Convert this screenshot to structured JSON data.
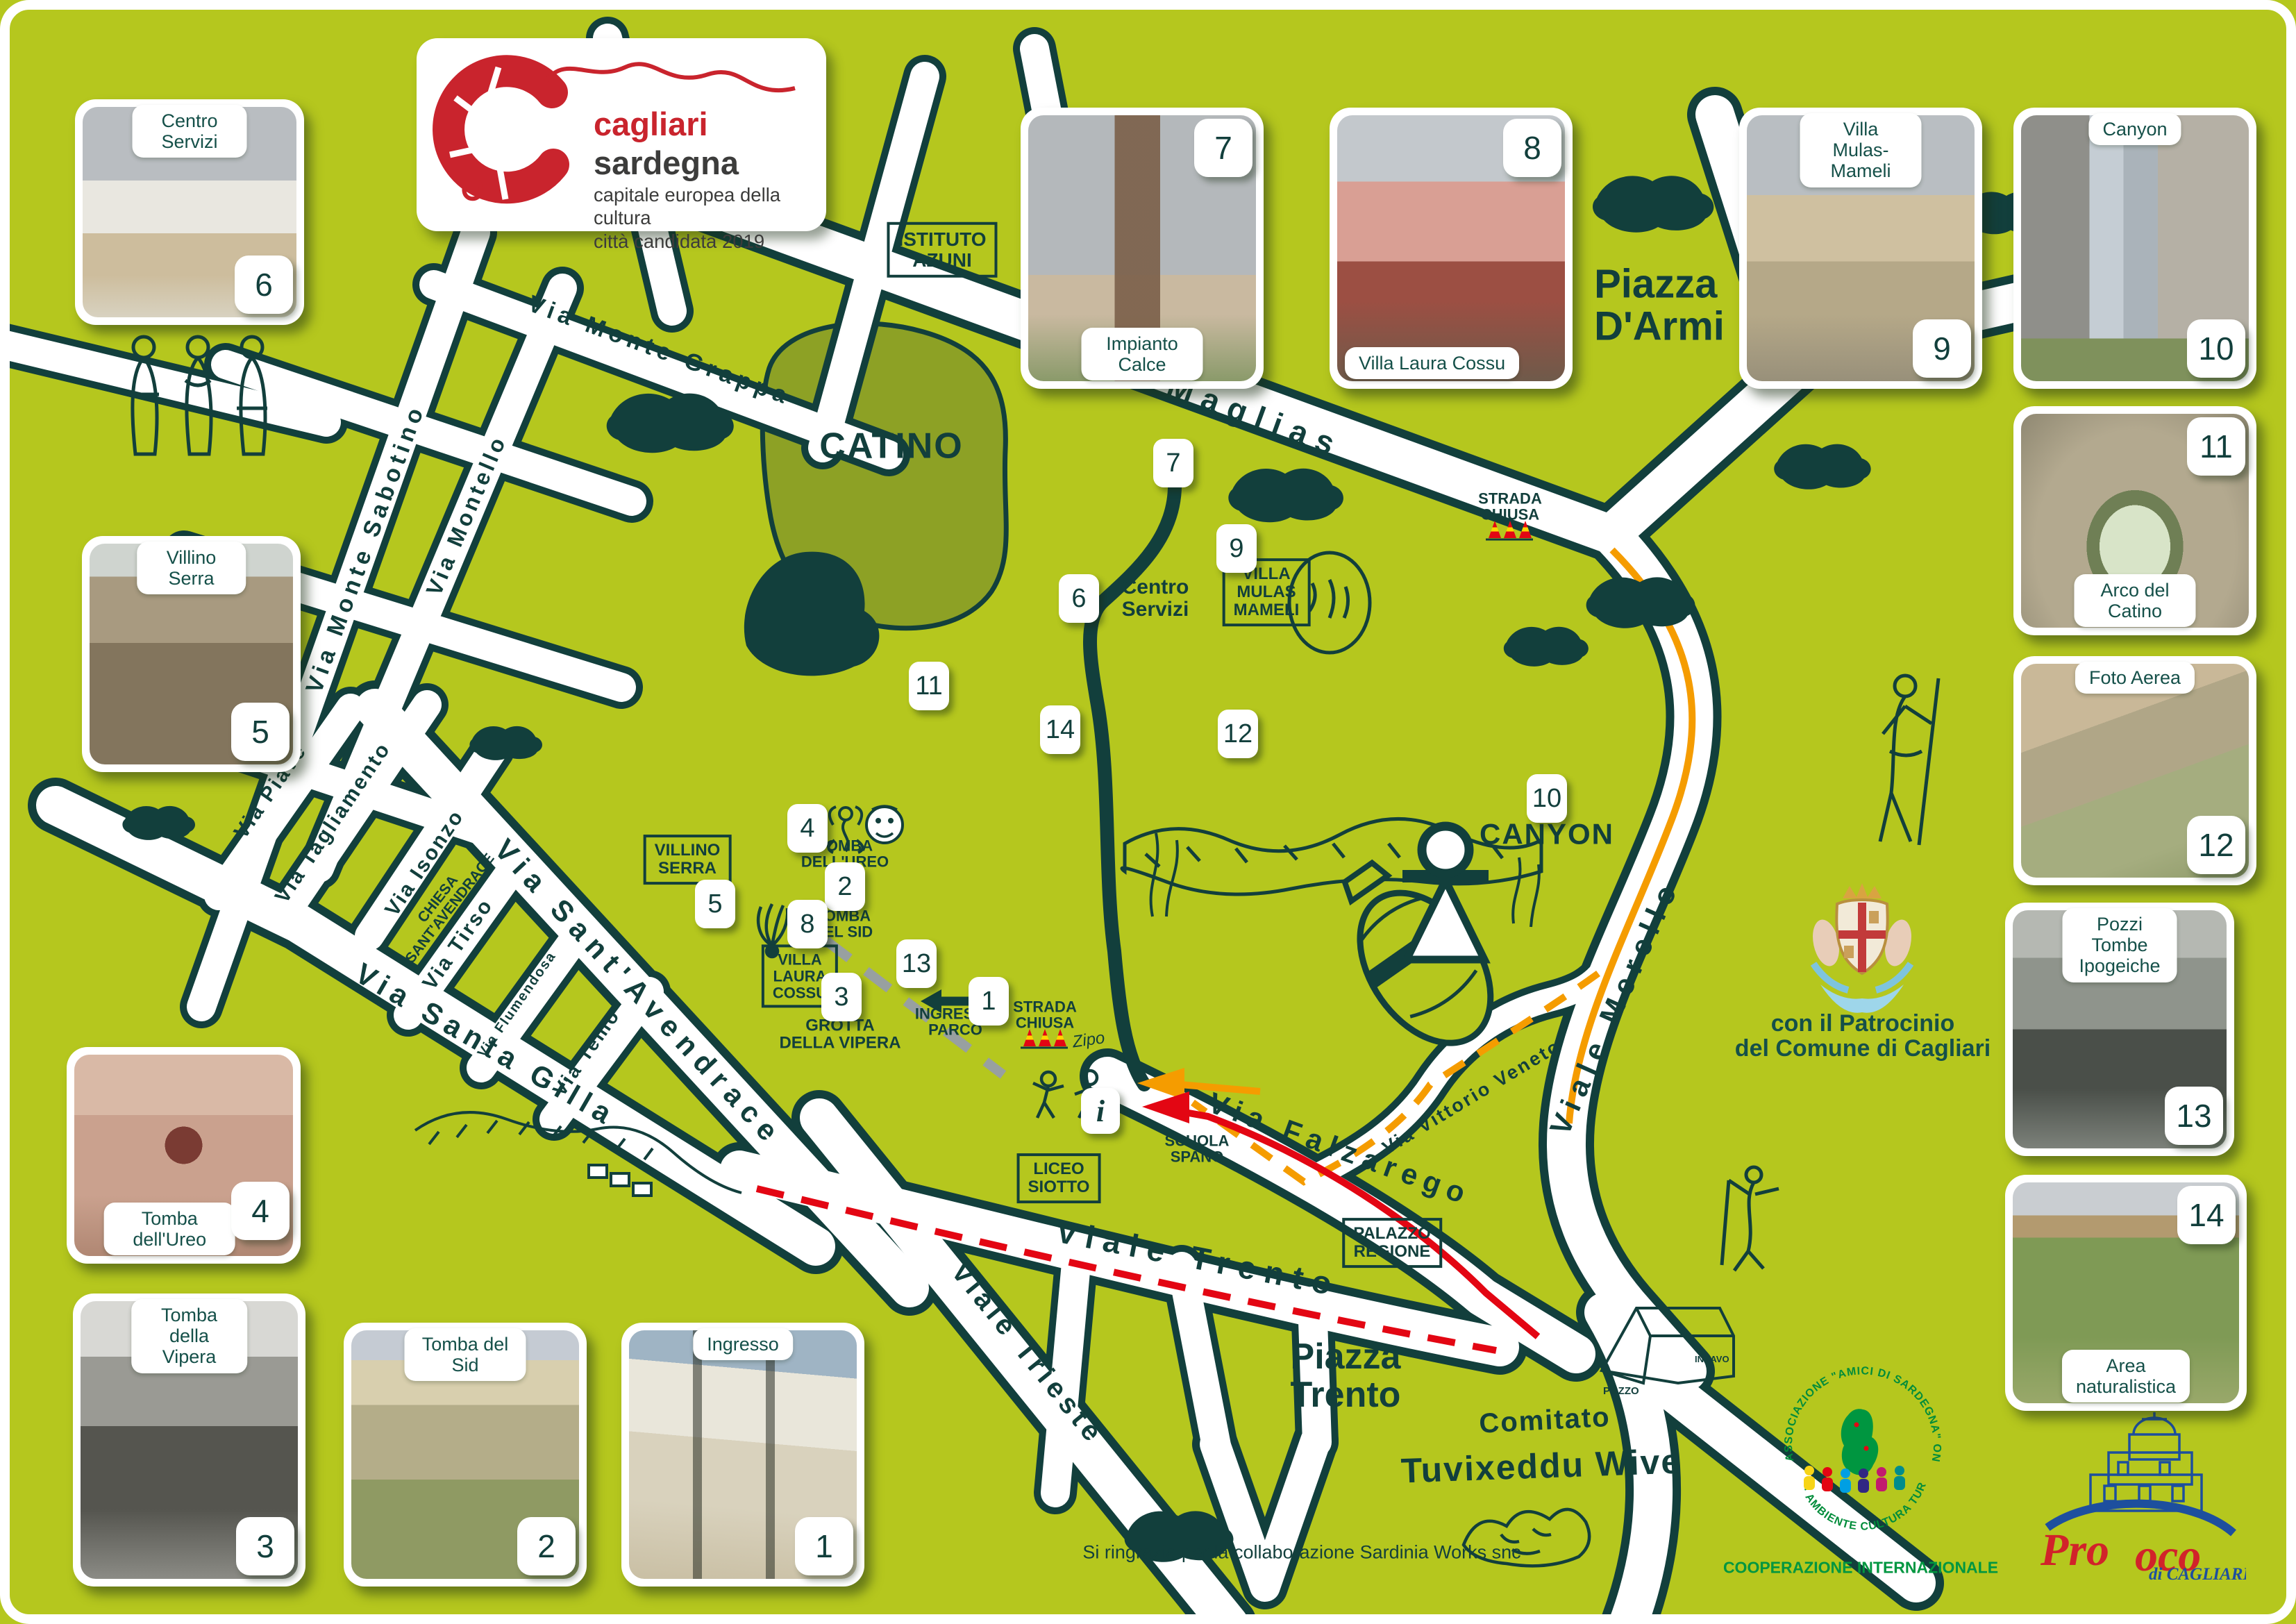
{
  "poster": {
    "logo": {
      "title_red": "cagliari",
      "title_dark": " sardegna",
      "subtitle1": "capitale europea della cultura",
      "subtitle2": "città candidata 2019"
    },
    "patronage": "con il Patrocinio\ndel Comune di Cagliari",
    "committee_line1": "Comitato",
    "committee_line2": "Tuvixeddu Wive",
    "association": {
      "arc_top": "ASSOCIAZIONE \"AMICI DI SARDEGNA\" ONLUS",
      "arc_bottom": "· AMBIENTE CULTURA TURISMO ·",
      "below": "COOPERAZIONE INTERNAZIONALE"
    },
    "proloco": {
      "pro": "Pro",
      "loco": "oco",
      "sub": "di CAGLIARI"
    },
    "thanks": "Si ringrazia per la collaborazione Sardinia Works snc"
  },
  "cards": [
    {
      "number": "1",
      "label": "Ingresso"
    },
    {
      "number": "2",
      "label": "Tomba del Sid"
    },
    {
      "number": "3",
      "label": "Tomba della Vipera"
    },
    {
      "number": "4",
      "label": "Tomba dell'Ureo"
    },
    {
      "number": "5",
      "label": "Villino Serra"
    },
    {
      "number": "6",
      "label": "Centro Servizi"
    },
    {
      "number": "7",
      "label": "Impianto Calce"
    },
    {
      "number": "8",
      "label": "Villa Laura Cossu"
    },
    {
      "number": "9",
      "label": "Villa Mulas-Mameli"
    },
    {
      "number": "10",
      "label": "Canyon"
    },
    {
      "number": "11",
      "label": "Arco del Catino"
    },
    {
      "number": "12",
      "label": "Foto Aerea"
    },
    {
      "number": "13",
      "label": "Pozzi Tombe\nIpogeiche"
    },
    {
      "number": "14",
      "label": "Area naturalistica"
    }
  ],
  "markers": [
    "1",
    "2",
    "3",
    "4",
    "5",
    "6",
    "7",
    "8",
    "9",
    "10",
    "11",
    "12",
    "13",
    "14"
  ],
  "streets": {
    "monte_sabotino": "Via Monte Sabotino",
    "monte_grappa": "Via Monte Grappa",
    "montello": "Via Montello",
    "is_maglias": "Via Is Maglias",
    "piave": "Via Piave",
    "tagliamento": "Via Tagliamento",
    "isonzo": "Via Isonzo",
    "santavendrace": "Via Sant'Avendrace",
    "santa_gilla": "Via Santa Gilla",
    "tirso": "Via Tirso",
    "flumendosa": "Via Flumendosa",
    "temo": "Via Temo",
    "trieste": "Viale Trieste",
    "trento": "Viale Trento",
    "falzarego": "Via Falzarego",
    "vittorio_veneto": "Via Vittorio Veneto",
    "merello": "Viale Merello"
  },
  "places": {
    "catino": "CATINO",
    "canyon": "CANYON",
    "piazza_darmi": "Piazza\nD'Armi",
    "piazza_trento": "Piazza\nTrento",
    "centro_servizi": "Centro\nServizi",
    "istituto_azuni": "ISTITUTO\nAZUNI",
    "villa_mulas_mameli": "VILLA\nMULAS\nMAMELI",
    "villino_serra": "VILLINO\nSERRA",
    "villa_laura_cossu": "VILLA\nLAURA\nCOSSU",
    "chiesa_santavendrace": "CHIESA\nSANT'AVENDRACE",
    "liceo_siotto": "LICEO\nSIOTTO",
    "palazzo_regione": "PALAZZO\nREGIONE",
    "scuola_spano": "SCUOLA\nSPANO",
    "tomba_ureo": "TOMBA\nDELL'UREO",
    "tomba_sid": "TOMBA\nDEL SID",
    "grotta_vipera": "GROTTA\nDELLA VIPERA",
    "ingresso_parco": "INGRESSO\nPARCO",
    "strada_chiusa": "STRADA\nCHIUSA",
    "info": "i",
    "zipo": "Zipo",
    "pozzo": "POZZO",
    "incavo": "INCAVO"
  },
  "colors": {
    "background": "#b5c71e",
    "dark": "#123f3c",
    "olive_area": "#8da125",
    "route_red": "#e30613",
    "route_orange": "#f59c00",
    "logo_red": "#c9242d",
    "association_green": "#009640",
    "proloco_blue": "#1d4f9e",
    "proloco_red": "#d1232a",
    "cone_yellow": "#ffd500"
  }
}
